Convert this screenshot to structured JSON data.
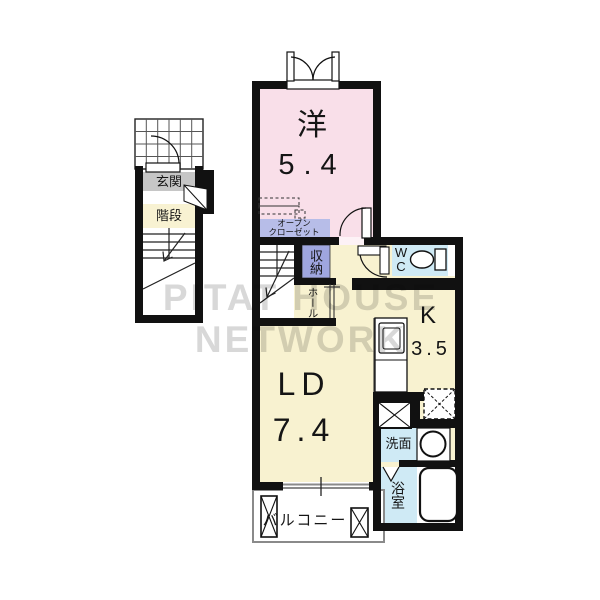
{
  "watermark_text": "PITAT HOUSE NETWORK",
  "colors": {
    "room_pink": "#f9dfe9",
    "floor_cream": "#f8f2d0",
    "wet_area_blue": "#cfeaf5",
    "closet_lavender": "#b7bde8",
    "storage_purple": "#9fa6df",
    "entrance_gray": "#c6c6c6",
    "wall_black": "#111111",
    "watermark_gray": "#d8d8d8"
  },
  "rooms": {
    "western": {
      "name": "洋",
      "area": "5.4"
    },
    "living_dining": {
      "name": "LD",
      "area": "7.4"
    },
    "kitchen": {
      "name": "K",
      "area": "3.5"
    },
    "wc": {
      "line1": "W",
      "line2": "C"
    },
    "washroom": {
      "name": "洗面"
    },
    "bathroom": {
      "name": "浴室"
    },
    "storage": {
      "name": "収納"
    },
    "hall": {
      "name": "ホール"
    },
    "open_closet": {
      "line1": "オープン",
      "line2": "クローゼット"
    },
    "balcony": {
      "name": "バルコニー"
    },
    "entrance": {
      "name": "玄関"
    },
    "stairs": {
      "name": "階段"
    }
  }
}
